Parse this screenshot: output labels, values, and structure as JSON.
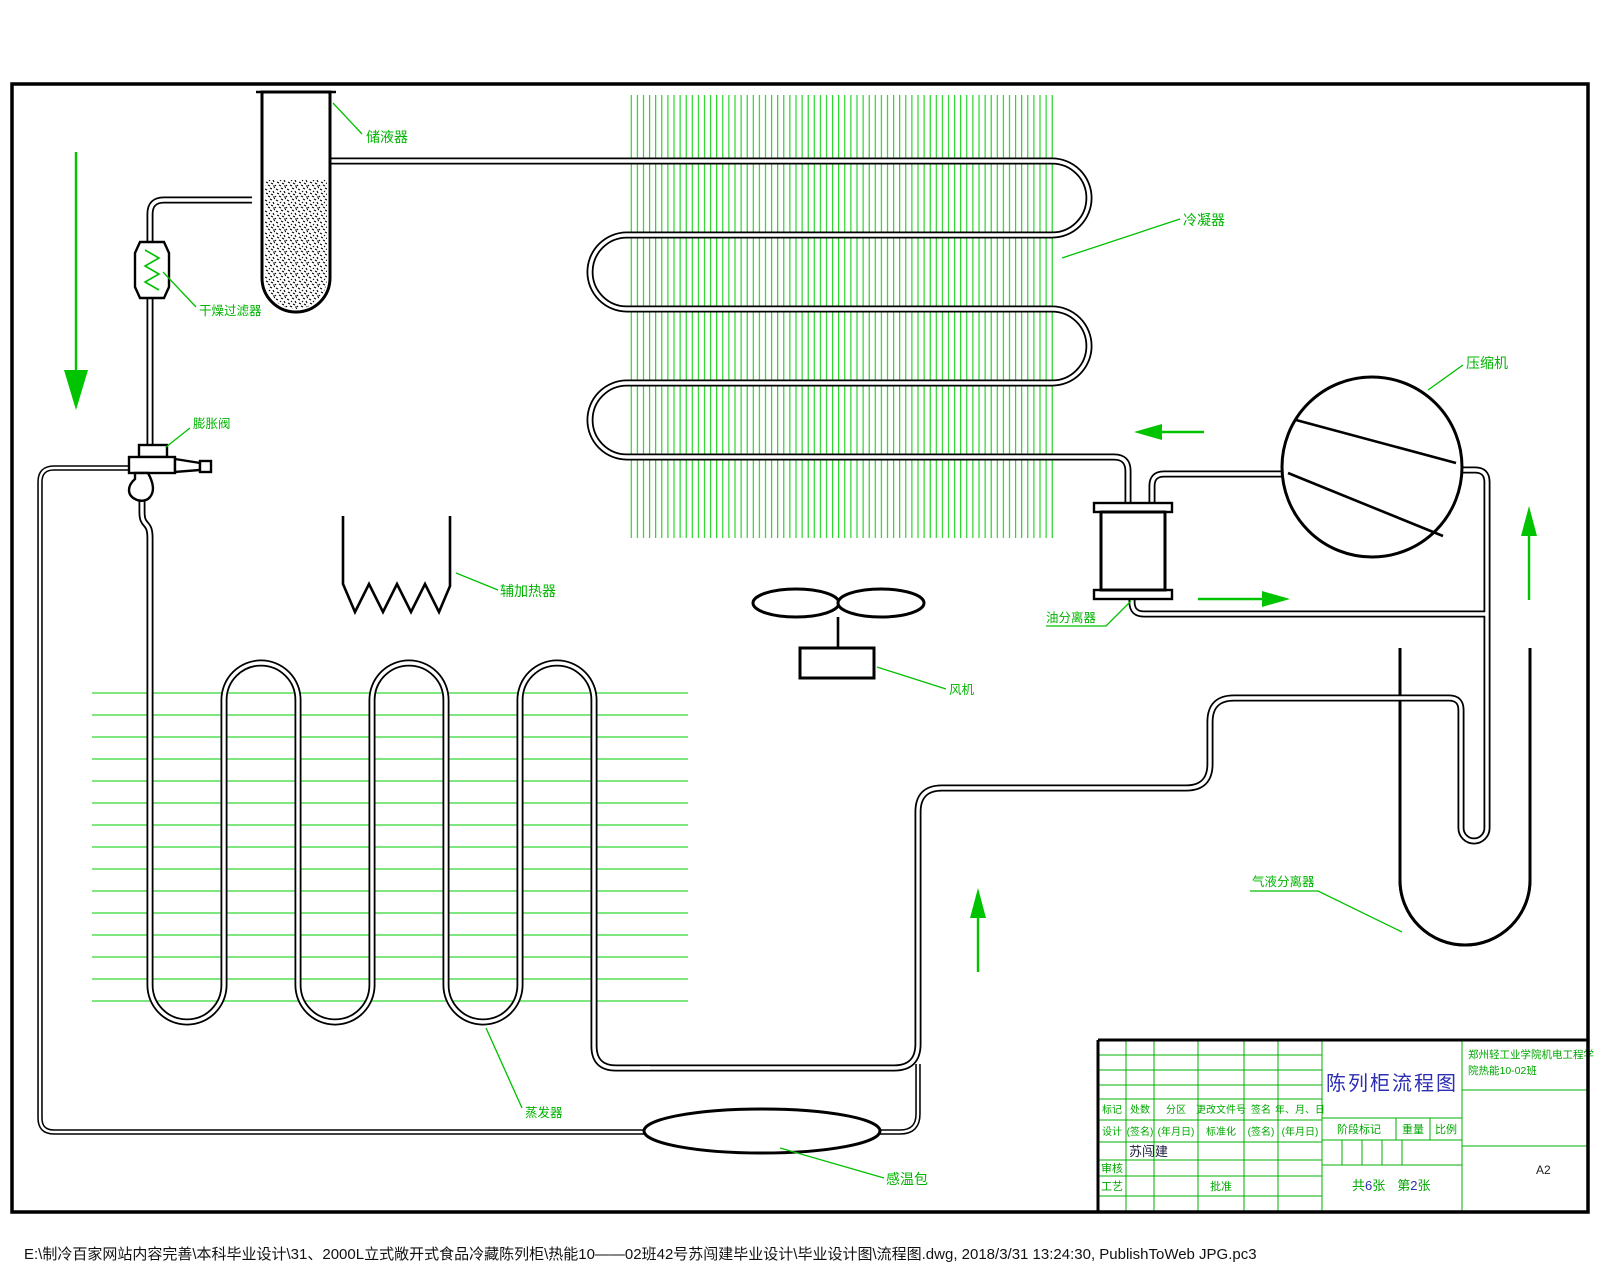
{
  "labels": {
    "receiver": "储液器",
    "filter_drier": "干燥过滤器",
    "expansion_valve": "膨胀阀",
    "condenser": "冷凝器",
    "compressor": "压缩机",
    "oil_separator": "油分离器",
    "fan": "风机",
    "aux_heater": "辅加热器",
    "evaporator": "蒸发器",
    "sensing_bulb": "感温包",
    "accumulator": "气液分离器"
  },
  "title_block": {
    "drawing_title": "陈列柜流程图",
    "school_line1": "郑州轻工业学院机电工程学",
    "school_line2": "院热能10-02班",
    "rev_header": [
      "标记",
      "处数",
      "分区",
      "更改文件号",
      "签名",
      "年、月、日"
    ],
    "sign_row": [
      "设计",
      "(签名)",
      "(年月日)",
      "标准化",
      "(签名)",
      "(年月日)"
    ],
    "designer_name": "苏闯建",
    "audit_label": "审核",
    "process_label": "工艺",
    "approve_label": "批准",
    "stage_label": "阶段标记",
    "weight_label": "重量",
    "scale_label": "比例",
    "sheet_total_prefix": "共",
    "sheet_total_num": "6",
    "sheet_total_suffix": "张",
    "sheet_no_prefix": "第",
    "sheet_no_num": "2",
    "sheet_no_suffix": "张",
    "paper_size": "A2"
  },
  "footer": {
    "path_text": "E:\\制冷百家网站内容完善\\本科毕业设计\\31、2000L立式敞开式食品冷藏陈列柜\\热能10——02班42号苏闯建毕业设计\\毕业设计图\\流程图.dwg, 2018/3/31 13:24:30, PublishToWeb JPG.pc3"
  },
  "colors": {
    "fin_green": "#00c800",
    "label_green": "#00b400",
    "title_blue": "#2d2db4",
    "ink": "#000000"
  }
}
